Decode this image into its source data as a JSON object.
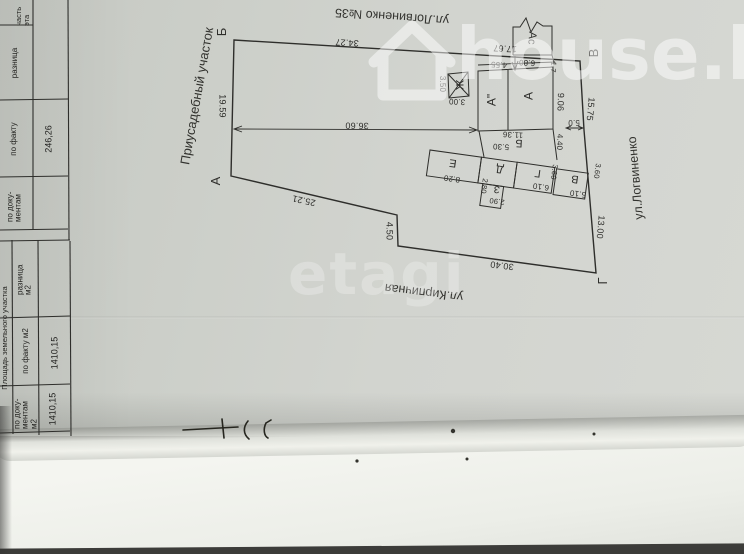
{
  "table": {
    "header_partial": "часть эта",
    "s1": {
      "diff_label": "разница",
      "fact_label": "по факту",
      "fact_value": "246,26",
      "docs_label": "по доку- ментам"
    },
    "s2": {
      "title": "Площадь земельного участка",
      "diff_label": "разница м2",
      "fact_label": "по факту м2",
      "fact_value": "1410,15",
      "docs_label": "по доку- ментам м2",
      "docs_value": "1410,15"
    }
  },
  "plan": {
    "area_label": "Приусадебный участок",
    "address": "ул.Логвиненко №35",
    "street_side": "ул.Логвиненко",
    "street_bottom": "ул.Кирпичная",
    "corners": {
      "a": "А",
      "b": "Б",
      "v": "В",
      "g": "Г"
    },
    "buildings": {
      "main": "А",
      "main2": "А\"",
      "annex": "Ас",
      "strip": "Б",
      "e": "Е",
      "d": "Д",
      "z": "З",
      "g": "Г",
      "v": "В",
      "j": "Ж"
    },
    "dims": {
      "top1": "34.27",
      "top2": "17.67",
      "left": "19.59",
      "diag": "25.21",
      "jog": "4.50",
      "bottom": "30.40",
      "right1": "15.75",
      "right2": "13.00",
      "inner": "36.60",
      "a_top1": "4.55",
      "a_top2": "6.80",
      "as_gap": "1.7",
      "a_right": "9.06",
      "gap5": "5.0",
      "b_gap": "4.40",
      "b_len": "11.36",
      "d_top": "5.30",
      "e_len": "8.20",
      "z_side": "2.80",
      "z_len": "2.90",
      "g_len": "6.10",
      "g_side": "3.60",
      "v_len": "5.10",
      "v_side": "3.60",
      "j_side": "3.50",
      "j_bot": "3.00"
    }
  },
  "watermarks": {
    "agency": "etagi",
    "brand": "house.kg"
  },
  "colors": {
    "ink": "#2e2e2b",
    "paper": "#cdd0ca",
    "watermark": "#ffffff"
  }
}
